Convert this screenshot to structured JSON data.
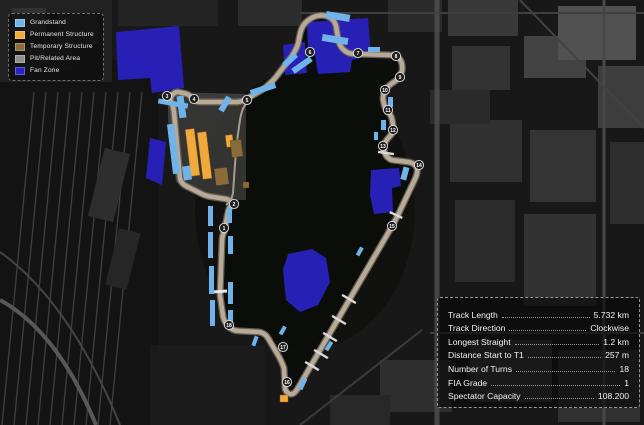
{
  "map": {
    "name": "circuit-satellite-map",
    "legend": {
      "items": [
        {
          "label": "Grandstand",
          "color": "#6FB3EA"
        },
        {
          "label": "Permanent Structure",
          "color": "#F2A93B"
        },
        {
          "label": "Temporary Structure",
          "color": "#8A6B3A"
        },
        {
          "label": "Pit/Related Area",
          "color": "#8F8F8F"
        },
        {
          "label": "Fan Zone",
          "color": "#2A22C4"
        }
      ]
    },
    "stats": {
      "rows": [
        {
          "label": "Track Length",
          "value": "5.732 km"
        },
        {
          "label": "Track Direction",
          "value": "Clockwise"
        },
        {
          "label": "Longest Straight",
          "value": "1.2 km"
        },
        {
          "label": "Distance Start to T1",
          "value": "257 m"
        },
        {
          "label": "Number of Turns",
          "value": "18"
        },
        {
          "label": "FIA Grade",
          "value": "1"
        },
        {
          "label": "Spectator Capacity",
          "value": "108.200"
        }
      ]
    },
    "track": {
      "track_color": "#B7AA97",
      "turn_markers": [
        {
          "n": "1",
          "x": 224,
          "y": 228
        },
        {
          "n": "2",
          "x": 234,
          "y": 204
        },
        {
          "n": "3",
          "x": 167,
          "y": 96
        },
        {
          "n": "4",
          "x": 194,
          "y": 99
        },
        {
          "n": "5",
          "x": 247,
          "y": 100
        },
        {
          "n": "6",
          "x": 310,
          "y": 52
        },
        {
          "n": "7",
          "x": 358,
          "y": 53
        },
        {
          "n": "8",
          "x": 396,
          "y": 56
        },
        {
          "n": "9",
          "x": 400,
          "y": 77
        },
        {
          "n": "10",
          "x": 385,
          "y": 90
        },
        {
          "n": "11",
          "x": 388,
          "y": 110
        },
        {
          "n": "12",
          "x": 393,
          "y": 130
        },
        {
          "n": "13",
          "x": 383,
          "y": 146
        },
        {
          "n": "14",
          "x": 419,
          "y": 165
        },
        {
          "n": "15",
          "x": 392,
          "y": 226
        },
        {
          "n": "16",
          "x": 287,
          "y": 382
        },
        {
          "n": "17",
          "x": 283,
          "y": 347
        },
        {
          "n": "18",
          "x": 229,
          "y": 325
        }
      ]
    }
  }
}
